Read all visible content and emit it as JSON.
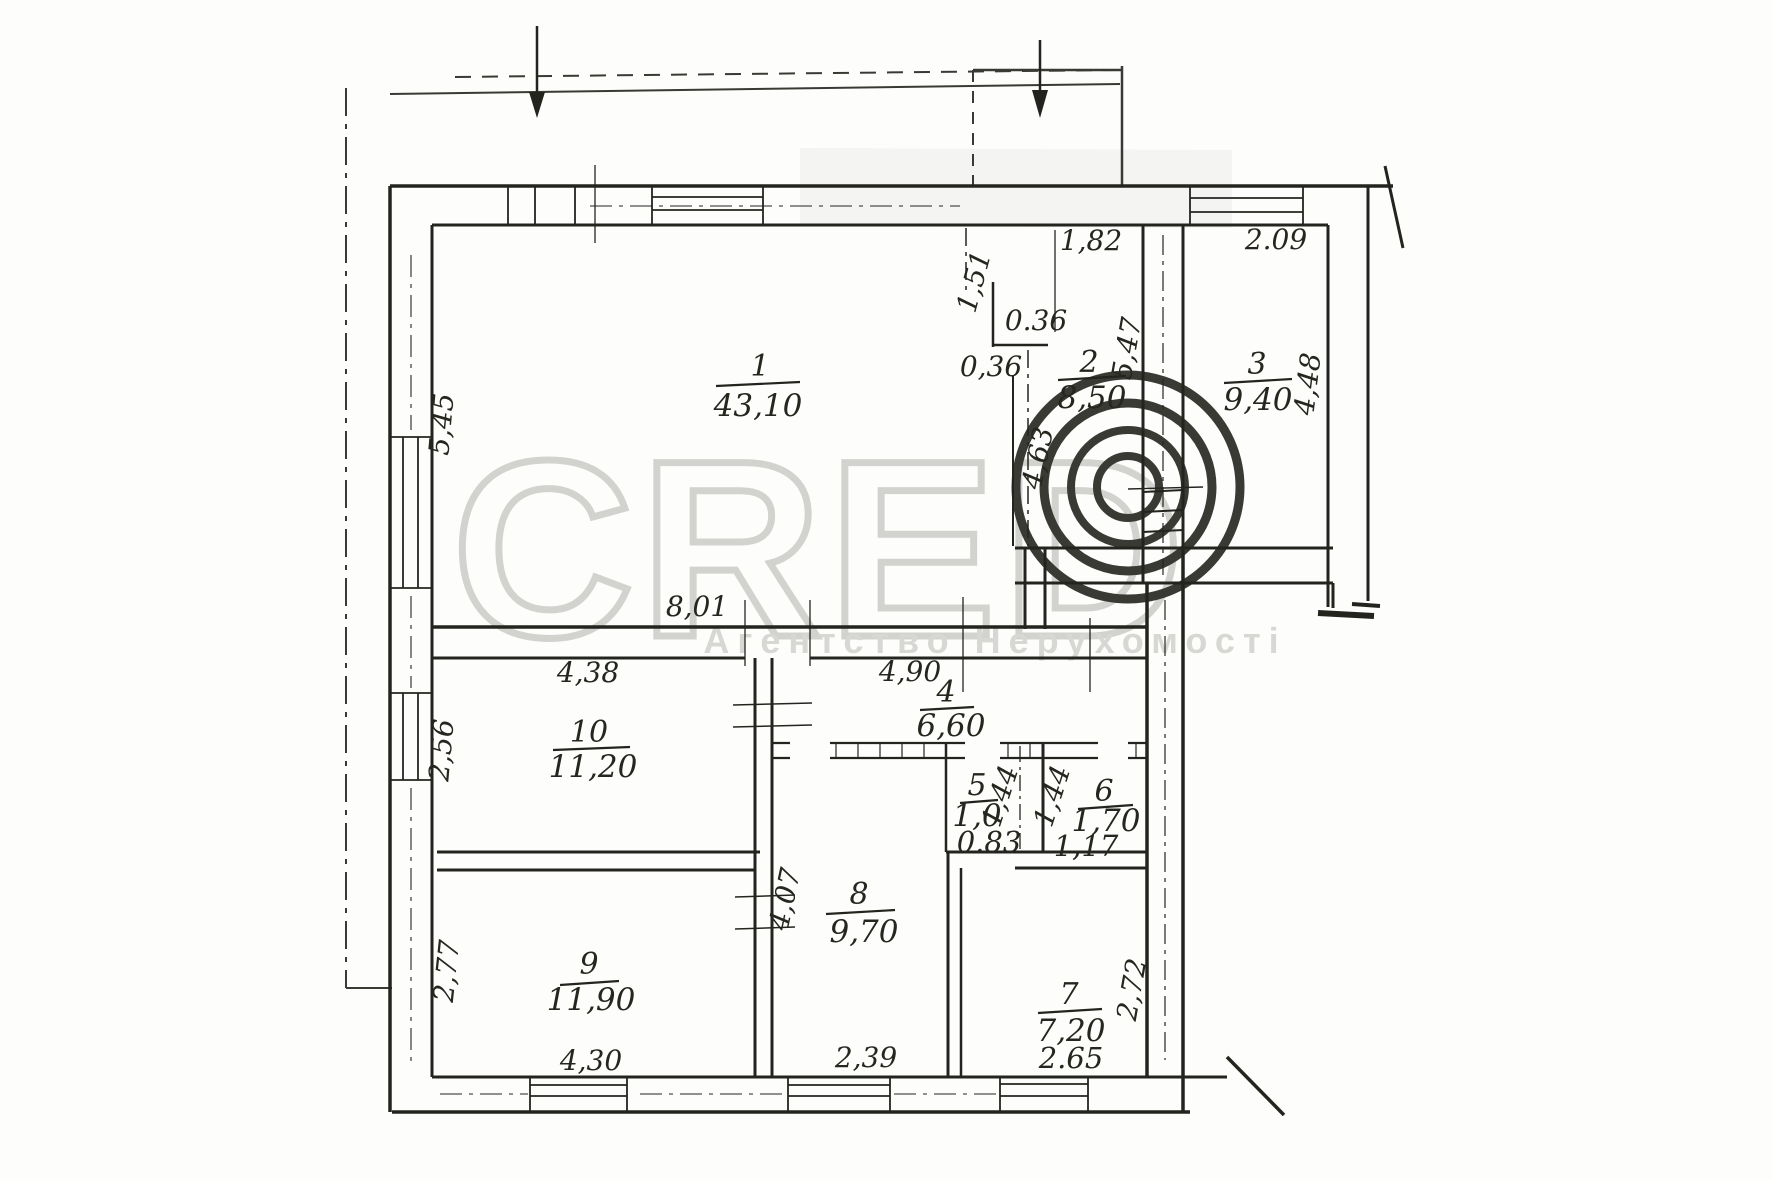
{
  "watermark": {
    "brand": "CRED",
    "copyright_symbol": "©",
    "subtitle": "Агентство Нерухомості"
  },
  "rooms": [
    {
      "number": "1",
      "area": "43,10"
    },
    {
      "number": "2",
      "area": "8,50"
    },
    {
      "number": "3",
      "area": "9,40"
    },
    {
      "number": "4",
      "area": "6,60"
    },
    {
      "number": "5",
      "area": "1,0",
      "width_dim": "0.83"
    },
    {
      "number": "6",
      "area": "1,70",
      "width_dim": "1,17"
    },
    {
      "number": "7",
      "area": "7,20",
      "width_dim": "2.65"
    },
    {
      "number": "8",
      "area": "9,70"
    },
    {
      "number": "9",
      "area": "11,90"
    },
    {
      "number": "10",
      "area": "11,20"
    }
  ],
  "dimensions": {
    "room1_left": "5,45",
    "room1_bottom": "8,01",
    "niche_depth": "1,51",
    "niche_width_upper": "0.36",
    "niche_width_lower": "0,36",
    "room2_top": "1,82",
    "room2_right": "5,47",
    "room3_top": "2.09",
    "room3_right": "4,48",
    "partition_1_2": "4,63",
    "room10_top": "4,38",
    "room10_left": "2,56",
    "corridor_top": "4,90",
    "room5_height": "1,44",
    "room6_height": "1,44",
    "room8_left": "4,07",
    "room8_bottom": "2,39",
    "room9_left": "2,77",
    "room9_bottom": "4,30",
    "room7_right": "2,72"
  },
  "colors": {
    "ink": "#24241f",
    "paper": "#fdfdfc",
    "watermark": "#d2d2cf"
  }
}
